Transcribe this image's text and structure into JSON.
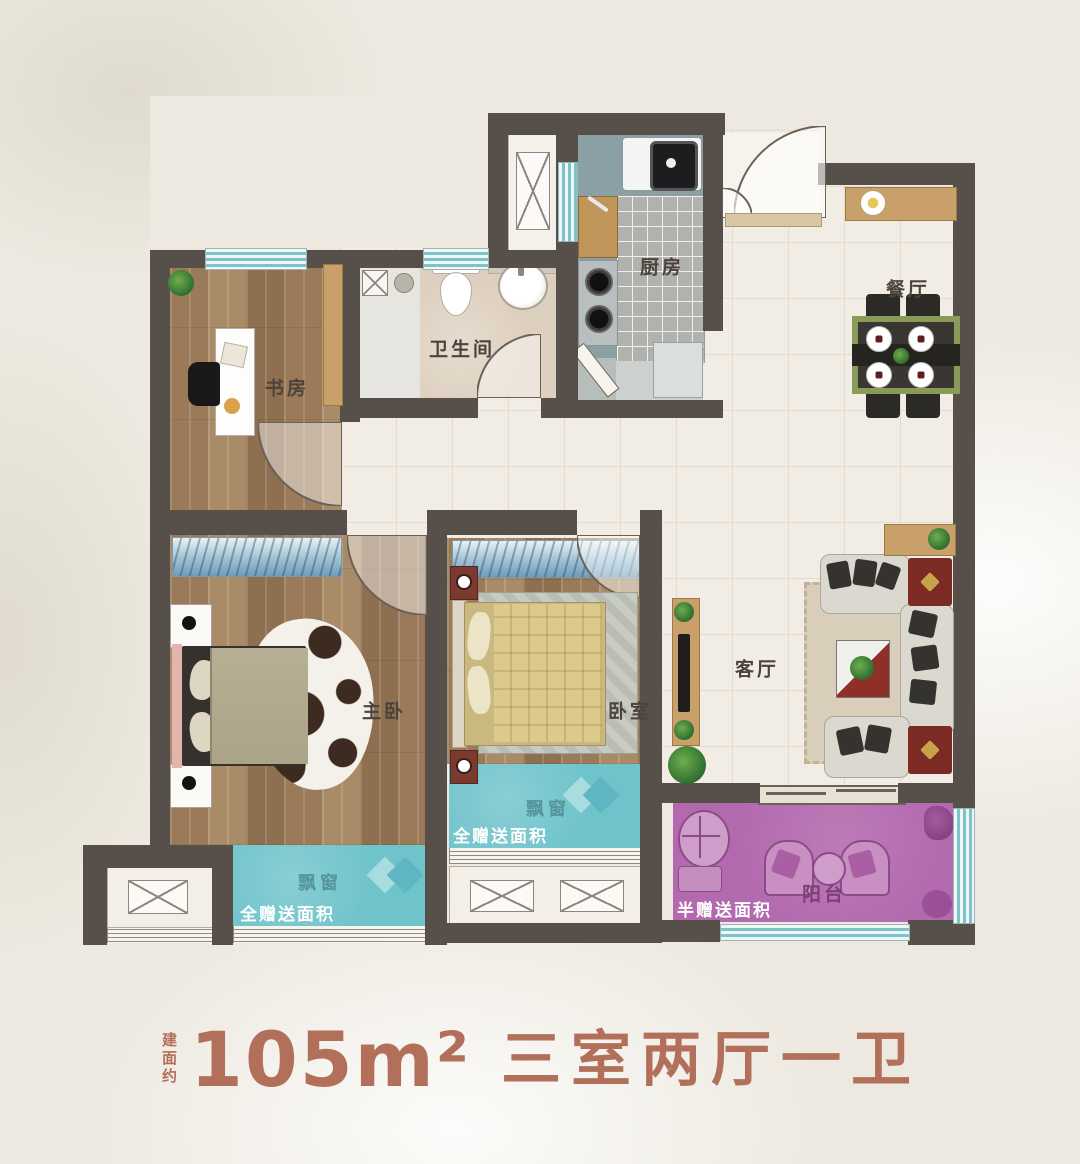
{
  "page": {
    "type": "apartment-floor-plan"
  },
  "title": {
    "built_area_prefix": "建面约",
    "area": "105m²",
    "layout": "三室两厅一卫"
  },
  "rooms": {
    "study": "书房",
    "bathroom": "卫生间",
    "kitchen": "厨房",
    "dining": "餐厅",
    "master_bedroom": "主卧",
    "bedroom": "卧室",
    "living_room": "客厅",
    "balcony": "阳台"
  },
  "annotations": {
    "bay_window": "飘窗",
    "full_gift": "全赠送面积",
    "half_gift": "半赠送面积"
  },
  "colors": {
    "wall": "#57504a",
    "bay_window": "#6fc3cb",
    "balcony": "#b269ae",
    "accent_text": "#b2705a",
    "wood_floor": "#a0805e",
    "tile_floor": "#f2ede4",
    "kitchen_counter": "#8aa0a4"
  }
}
